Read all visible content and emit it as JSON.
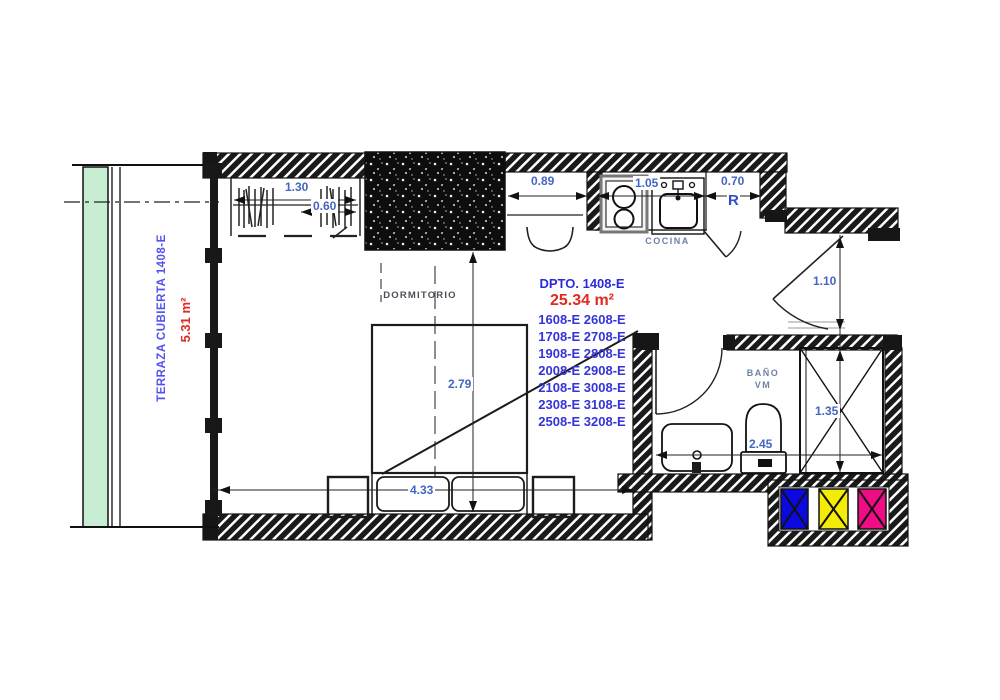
{
  "plan": {
    "terrace": {
      "label": "TERRAZA CUBIERTA 1408-E",
      "area": "5.31 m²"
    },
    "unit": {
      "name": "DPTO. 1408-E",
      "area": "25.34 m²",
      "stack": [
        "1608-E 2608-E",
        "1708-E 2708-E",
        "1908-E 2808-E",
        "2008-E 2908-E",
        "2108-E 3008-E",
        "2308-E 3108-E",
        "2508-E 3208-E"
      ]
    },
    "rooms": {
      "bedroom": "DORMITORIO",
      "kitchen": "COCINA",
      "bathroom_line1": "BAÑO",
      "bathroom_line2": "VM",
      "refrigerator": "R"
    },
    "dims": {
      "closet_width": "1.30",
      "closet_depth": "0.60",
      "desk": "0.89",
      "kitchen_counter": "1.05",
      "fridge_space": "0.70",
      "entry_clearance": "1.10",
      "bedroom_depth": "2.79",
      "bedroom_width": "4.33",
      "bath_width": "2.45",
      "shower_width": "1.35"
    },
    "colors": {
      "terrace_green": "#c7eed2",
      "legend_blue": "#0a0ae0",
      "legend_yellow": "#f5ec06",
      "legend_magenta": "#ee0d84",
      "dim_text": "#4466c2",
      "unit_blue": "#2b2bdc",
      "area_red": "#e02a22",
      "terrace_blue": "#5252ee",
      "room_label_gray": "#6f7fa6"
    }
  }
}
